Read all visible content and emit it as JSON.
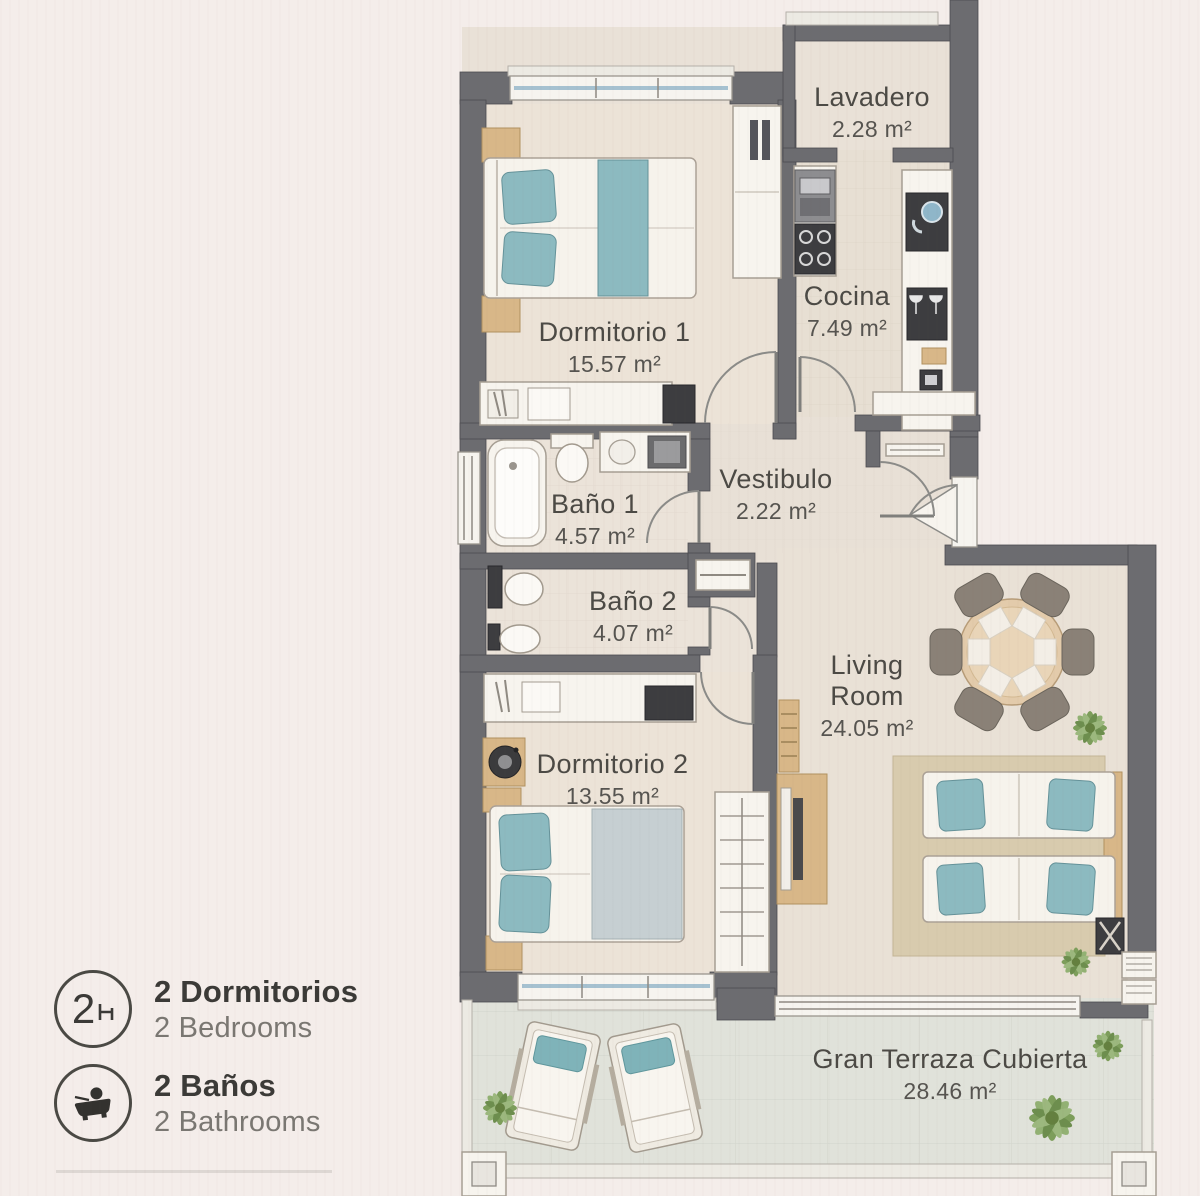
{
  "rooms": {
    "lavadero": {
      "name": "Lavadero",
      "area": "2.28 m²"
    },
    "cocina": {
      "name": "Cocina",
      "area": "7.49 m²"
    },
    "dormitorio1": {
      "name": "Dormitorio 1",
      "area": "15.57 m²"
    },
    "bano1": {
      "name": "Baño 1",
      "area": "4.57 m²"
    },
    "vestibulo": {
      "name": "Vestibulo",
      "area": "2.22 m²"
    },
    "bano2": {
      "name": "Baño 2",
      "area": "4.07 m²"
    },
    "dormitorio2": {
      "name": "Dormitorio 2",
      "area": "13.55 m²"
    },
    "living": {
      "name": "Living Room",
      "area": "24.05 m²"
    },
    "terraza": {
      "name": "Gran Terraza Cubierta",
      "area": "28.46 m²"
    }
  },
  "legend": {
    "items": [
      {
        "badge": "2",
        "icon": "bed-icon",
        "title": "2 Dormitorios",
        "subtitle": "2 Bedrooms"
      },
      {
        "badge": "",
        "icon": "bathtub-icon",
        "title": "2 Baños",
        "subtitle": "2 Bathrooms"
      }
    ]
  },
  "colors": {
    "background": "#f4edea",
    "wall": "#6c6c70",
    "floor": "#eae2d8",
    "terrace_floor": "#e0e2da",
    "accent_teal": "#8cbac0",
    "wood_tan": "#d8b788",
    "rug": "#d8cbae",
    "label_text": "#4c4a45",
    "legend_title": "#3b3a37",
    "legend_subtitle": "#7a7772"
  }
}
